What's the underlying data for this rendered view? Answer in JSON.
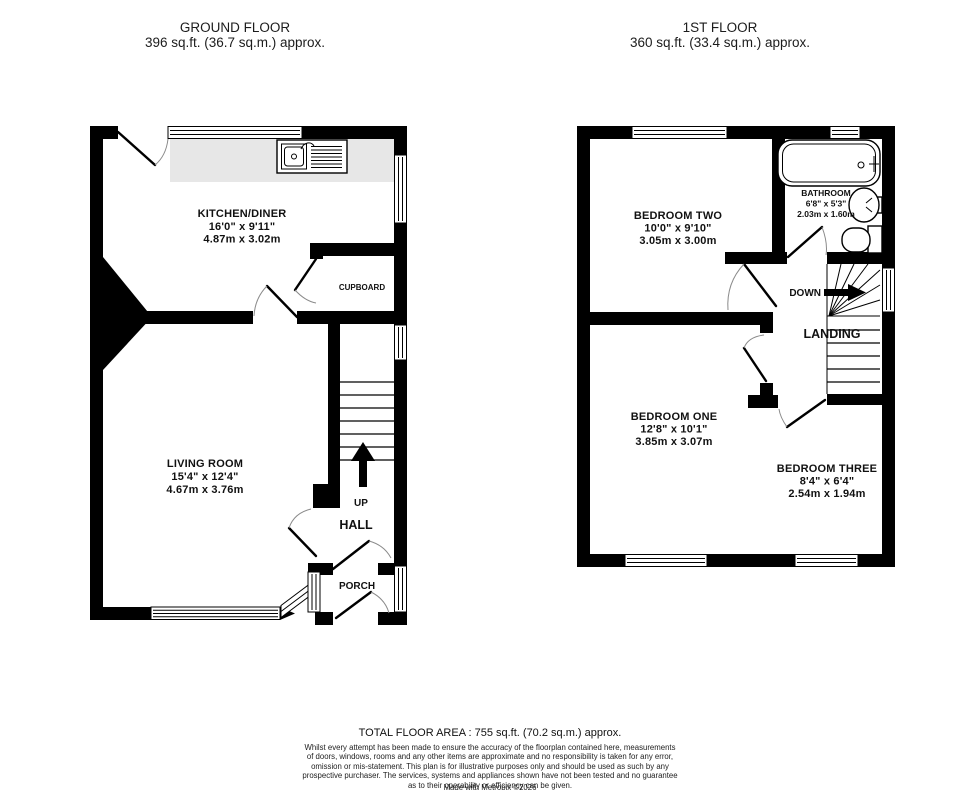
{
  "ground_floor": {
    "title": "GROUND FLOOR",
    "area": "396 sq.ft. (36.7 sq.m.) approx.",
    "kitchen": {
      "name": "KITCHEN/DINER",
      "imperial": "16'0\" x 9'11\"",
      "metric": "4.87m x 3.02m"
    },
    "living": {
      "name": "LIVING ROOM",
      "imperial": "15'4\" x 12'4\"",
      "metric": "4.67m x 3.76m"
    },
    "cupboard": "CUPBOARD",
    "hall": "HALL",
    "porch": "PORCH",
    "up": "UP"
  },
  "first_floor": {
    "title": "1ST FLOOR",
    "area": "360 sq.ft. (33.4 sq.m.) approx.",
    "bedroom_two": {
      "name": "BEDROOM TWO",
      "imperial": "10'0\" x 9'10\"",
      "metric": "3.05m x 3.00m"
    },
    "bathroom": {
      "name": "BATHROOM",
      "imperial": "6'8\" x 5'3\"",
      "metric": "2.03m x 1.60m"
    },
    "bedroom_one": {
      "name": "BEDROOM ONE",
      "imperial": "12'8\" x 10'1\"",
      "metric": "3.85m x 3.07m"
    },
    "bedroom_three": {
      "name": "BEDROOM THREE",
      "imperial": "8'4\" x 6'4\"",
      "metric": "2.54m x 1.94m"
    },
    "landing": "LANDING",
    "down": "DOWN"
  },
  "footer": {
    "total": "TOTAL FLOOR AREA : 755 sq.ft. (70.2 sq.m.) approx.",
    "disclaimer_lines": [
      "Whilst every attempt has been made to ensure the accuracy of the floorplan contained here, measurements",
      "of doors, windows, rooms and any other items are approximate and no responsibility is taken for any error,",
      "omission or mis-statement. This plan is for illustrative purposes only and should be used as such by any",
      "prospective purchaser. The services, systems and appliances shown have not been tested and no guarantee",
      "as to their operability or efficiency can be given."
    ],
    "credit": "Made with Metropix ©2026"
  },
  "colors": {
    "wall": "#000000",
    "counter": "#e7e7e7",
    "background": "#ffffff"
  }
}
